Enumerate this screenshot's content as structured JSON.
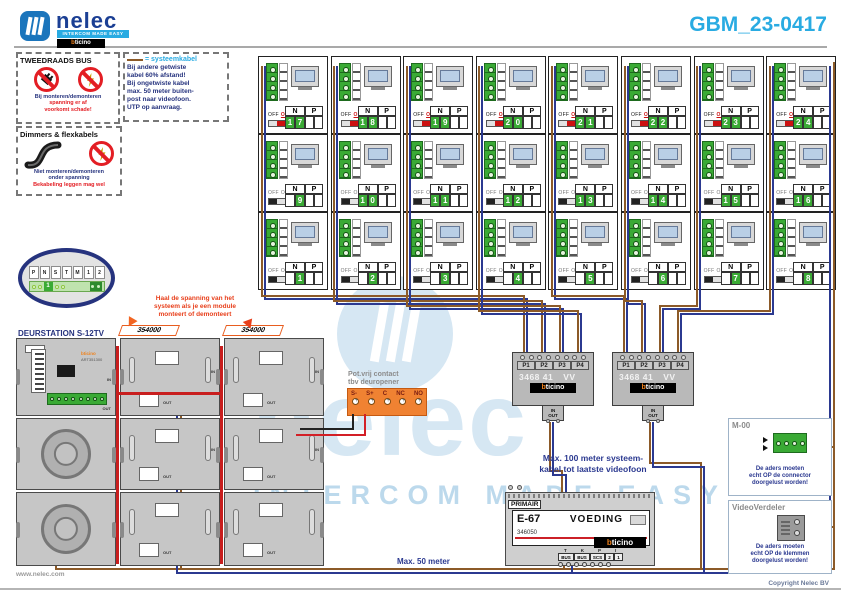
{
  "colors": {
    "accent": "#29abe2",
    "navy": "#26337e",
    "blue-text": "#2b3990",
    "red": "#e31e24",
    "green": "#3aaa35",
    "wire-brown": "#8c5a28",
    "wire-blue": "#2b3990",
    "wire-red": "#c81e1e",
    "orange": "#ef7d24",
    "bticino-orange": "#f08019"
  },
  "header": {
    "brand": "nelec",
    "tagline": "INTERCOM MADE EASY",
    "title": "GBM_23-0417"
  },
  "bticino": {
    "b": "b",
    "rest": "ticino"
  },
  "watermark": {
    "word": "nelec",
    "tagline": "INTERCOM MADE EASY"
  },
  "notes": {
    "tweedraads": {
      "title": "TWEEDRAADS BUS",
      "line1": "Bij monteren/demonteren",
      "line2": "spanning er af",
      "line3": "voorkomt schade!"
    },
    "systeemkabel": {
      "legend": "= systeemkabel",
      "lines": [
        "Bij andere getwiste",
        "kabel 60% afstand!",
        "Bij ongetwiste kabel",
        "max. 50 meter buiten-",
        "post naar videofoon.",
        "UTP op aanvraag."
      ]
    },
    "flex": {
      "title": "Dimmers & flexkabels",
      "line1": "Niet monteren/demonteren",
      "line2": "onder spanning",
      "line3": "Bekabeling leggen mag wel"
    },
    "spanning": [
      "Haal de spanning van het",
      "systeem als je een module",
      "monteert of demonteert"
    ],
    "max100": [
      "Max. 100 meter systeem-",
      "kabel tot laatste videofoon"
    ],
    "max50": "Max. 50 meter"
  },
  "grid": {
    "labels": {
      "off": "OFF",
      "on": "ON",
      "n": "N",
      "p": "P"
    },
    "units": [
      {
        "n": 17,
        "on": true
      },
      {
        "n": 18,
        "on": true
      },
      {
        "n": 19,
        "on": true
      },
      {
        "n": 20,
        "on": true
      },
      {
        "n": 21,
        "on": true
      },
      {
        "n": 22,
        "on": true
      },
      {
        "n": 23,
        "on": true
      },
      {
        "n": 24,
        "on": true
      },
      {
        "n": 9,
        "on": false
      },
      {
        "n": 10,
        "on": false
      },
      {
        "n": 11,
        "on": false
      },
      {
        "n": 12,
        "on": false
      },
      {
        "n": 13,
        "on": false
      },
      {
        "n": 14,
        "on": false
      },
      {
        "n": 15,
        "on": false
      },
      {
        "n": 16,
        "on": false
      },
      {
        "n": 1,
        "on": false
      },
      {
        "n": 2,
        "on": false
      },
      {
        "n": 3,
        "on": false
      },
      {
        "n": 4,
        "on": false
      },
      {
        "n": 5,
        "on": false
      },
      {
        "n": 6,
        "on": false
      },
      {
        "n": 7,
        "on": false
      },
      {
        "n": 8,
        "on": false
      }
    ]
  },
  "bubble": {
    "pins": [
      "P",
      "N",
      "S",
      "T",
      "M",
      "1",
      "2"
    ],
    "badge": "1"
  },
  "deurstation": {
    "title": "DEURSTATION S-12TV",
    "ribbon1": "354000",
    "ribbon2": "354000",
    "art": "ART351300",
    "in": "IN",
    "out": "OUT"
  },
  "potvrij": {
    "caption1": "Pot.vrij contact",
    "caption2": "tbv deuropener",
    "terminals": [
      "S-",
      "S+",
      "C",
      "NC",
      "NO"
    ]
  },
  "distributor": {
    "model": "3468 41",
    "vv": "VV",
    "ports": [
      "P1",
      "P2",
      "P3",
      "P4"
    ],
    "in": "IN",
    "out": "OUT"
  },
  "psu": {
    "primair": "PRIMAIR",
    "model": "E-67",
    "voeding": "VOEDING",
    "art": "346050",
    "tk": "TK",
    "pi": "PI",
    "terminals": [
      "BUS",
      "BUS",
      "SCS",
      "2",
      "1"
    ]
  },
  "m00": {
    "title": "M-00",
    "lines": [
      "De aders moeten",
      "echt OP de connector",
      "doorgelust worden!"
    ]
  },
  "verdeler": {
    "title": "VideoVerdeler",
    "lines": [
      "De aders moeten",
      "echt OP de klemmen",
      "doorgelust worden!"
    ]
  },
  "footer": {
    "site": "www.nelec.com",
    "copyright": "Copyright Nelec BV"
  }
}
